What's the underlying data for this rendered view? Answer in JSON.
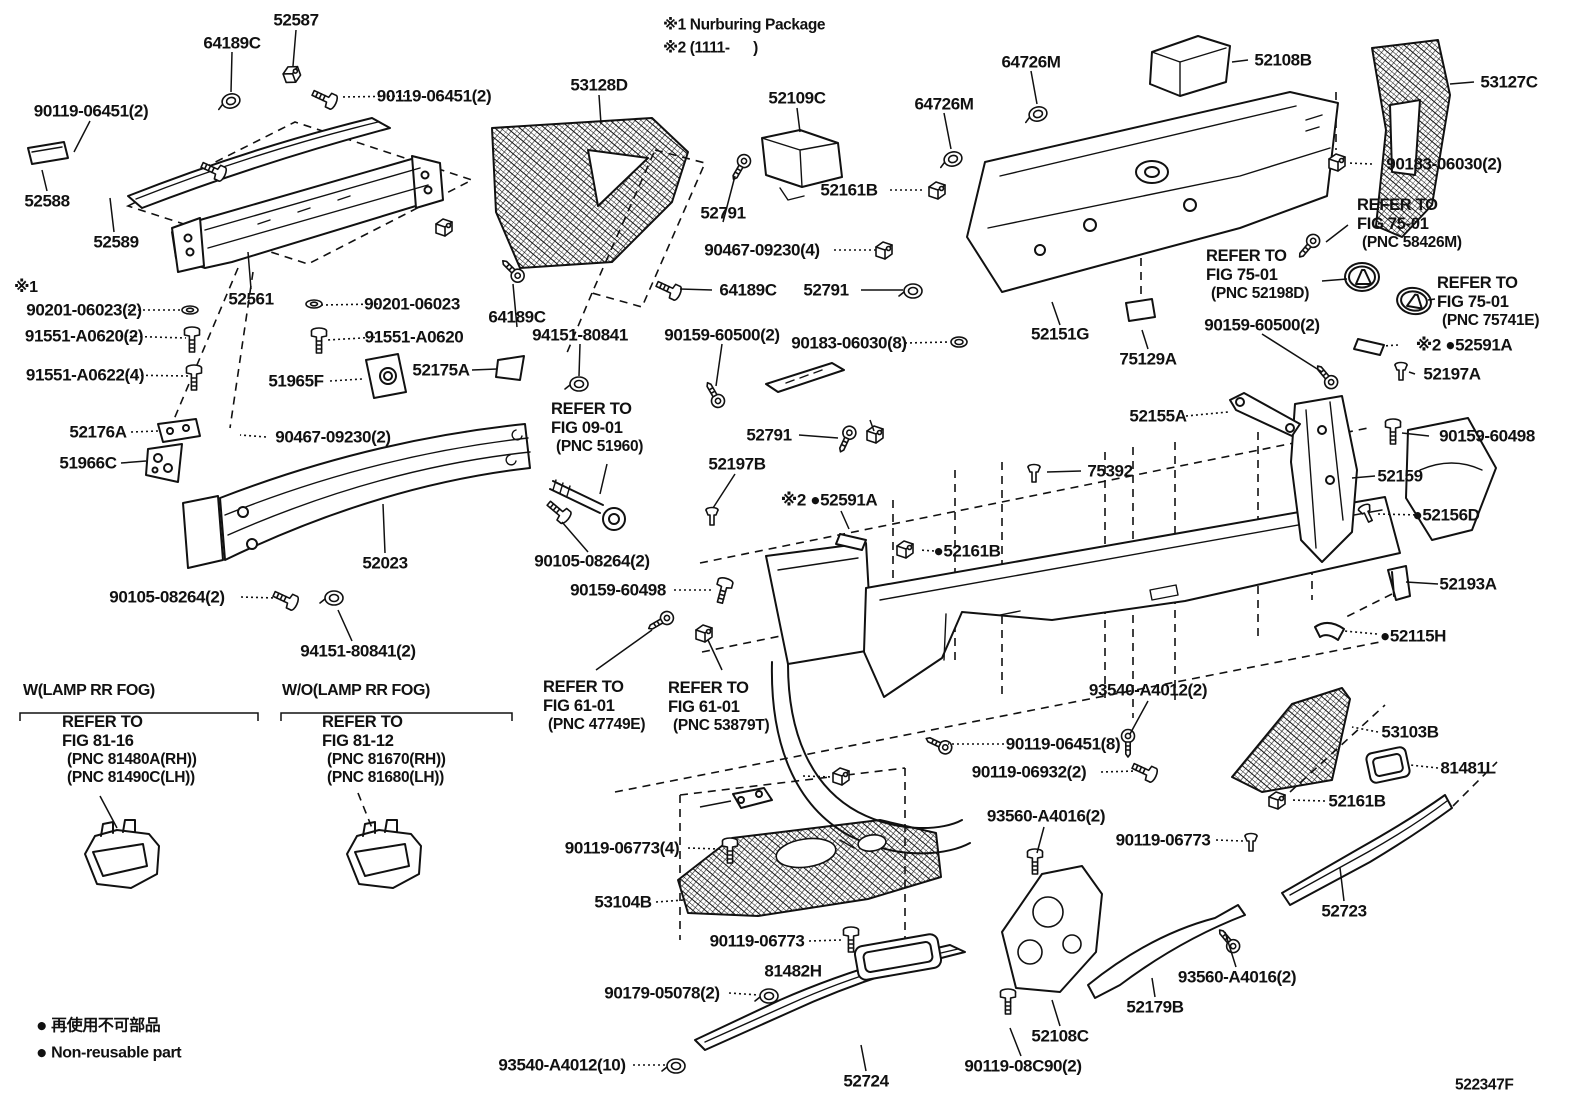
{
  "colors": {
    "ink": "#111111",
    "background": "#ffffff"
  },
  "code": {
    "t": "522347F",
    "x": 1455,
    "y": 1085
  },
  "notes": [
    {
      "t": "※1 Nurburing Package",
      "x": 663,
      "y": 25
    },
    {
      "t": "※2 (1111-      )",
      "x": 663,
      "y": 48
    }
  ],
  "legend": {
    "rows": [
      {
        "symbol": "●",
        "text": "再使用不可部品",
        "x": 36,
        "y": 1026
      },
      {
        "symbol": "●",
        "text": "Non-reusable part",
        "x": 36,
        "y": 1053
      }
    ]
  },
  "labels": [
    {
      "id": "52587",
      "t": "52587",
      "x": 296,
      "y": 20
    },
    {
      "id": "64189c-top",
      "t": "64189C",
      "x": 232,
      "y": 43
    },
    {
      "id": "90119-06451-2-left",
      "t": "90119-06451(2)",
      "x": 91,
      "y": 111
    },
    {
      "id": "90119-06451-2-right",
      "t": "90119-06451(2)",
      "x": 434,
      "y": 96
    },
    {
      "id": "52588",
      "t": "52588",
      "x": 47,
      "y": 201
    },
    {
      "id": "52589",
      "t": "52589",
      "x": 116,
      "y": 242
    },
    {
      "id": "53128d",
      "t": "53128D",
      "x": 599,
      "y": 85
    },
    {
      "id": "52109c",
      "t": "52109C",
      "x": 797,
      "y": 98
    },
    {
      "id": "64726m-upper",
      "t": "64726M",
      "x": 1031,
      "y": 62
    },
    {
      "id": "64726m-lower",
      "t": "64726M",
      "x": 944,
      "y": 104
    },
    {
      "id": "52108b",
      "t": "52108B",
      "x": 1283,
      "y": 60
    },
    {
      "id": "53127c",
      "t": "53127C",
      "x": 1509,
      "y": 82
    },
    {
      "id": "90183-06030-2",
      "t": "90183-06030(2)",
      "x": 1444,
      "y": 164
    },
    {
      "id": "52161b-top",
      "t": "52161B",
      "x": 849,
      "y": 190
    },
    {
      "id": "52791-top",
      "t": "52791",
      "x": 723,
      "y": 213
    },
    {
      "id": "90467-09230-4-top",
      "t": "90467-09230(4)",
      "x": 762,
      "y": 250
    },
    {
      "id": "64189c-mid2",
      "t": "64189C",
      "x": 748,
      "y": 290
    },
    {
      "id": "52791-mid",
      "t": "52791",
      "x": 826,
      "y": 290
    },
    {
      "id": "52151g",
      "t": "52151G",
      "x": 1060,
      "y": 334
    },
    {
      "id": "75129a",
      "t": "75129A",
      "x": 1148,
      "y": 359
    },
    {
      "id": "90159-60500-2-right",
      "t": "90159-60500(2)",
      "x": 1262,
      "y": 325
    },
    {
      "id": "52591a-right",
      "t": "※2 ●52591A",
      "x": 1464,
      "y": 345
    },
    {
      "id": "52197a",
      "t": "52197A",
      "x": 1452,
      "y": 374
    },
    {
      "id": "90159-60498-right",
      "t": "90159-60498",
      "x": 1487,
      "y": 436
    },
    {
      "id": "52159",
      "t": "52159",
      "x": 1400,
      "y": 476
    },
    {
      "id": "52156d",
      "t": "●52156D",
      "x": 1446,
      "y": 515
    },
    {
      "id": "52155a",
      "t": "52155A",
      "x": 1158,
      "y": 416
    },
    {
      "id": "90159-60500-2-left",
      "t": "90159-60500(2)",
      "x": 722,
      "y": 335
    },
    {
      "id": "90183-06030-8",
      "t": "90183-06030(8)",
      "x": 849,
      "y": 343
    },
    {
      "id": "64189c-mid",
      "t": "64189C",
      "x": 517,
      "y": 317
    },
    {
      "id": "94151-80841",
      "t": "94151-80841",
      "x": 580,
      "y": 335
    },
    {
      "id": "note1-mark",
      "t": "※1",
      "x": 14,
      "y": 288,
      "a": "l",
      "fs": 16
    },
    {
      "id": "90201-06023-2",
      "t": "90201-06023(2)",
      "x": 84,
      "y": 310
    },
    {
      "id": "91551-a0620-2",
      "t": "91551-A0620(2)",
      "x": 84,
      "y": 336
    },
    {
      "id": "91551-a0622-4",
      "t": "91551-A0622(4)",
      "x": 85,
      "y": 375
    },
    {
      "id": "52561",
      "t": "52561",
      "x": 251,
      "y": 299
    },
    {
      "id": "90201-06023",
      "t": "90201-06023",
      "x": 412,
      "y": 304
    },
    {
      "id": "91551-a0620",
      "t": "91551-A0620",
      "x": 414,
      "y": 337
    },
    {
      "id": "51965f",
      "t": "51965F",
      "x": 296,
      "y": 381
    },
    {
      "id": "52175a",
      "t": "52175A",
      "x": 441,
      "y": 370
    },
    {
      "id": "52176a",
      "t": "52176A",
      "x": 98,
      "y": 432
    },
    {
      "id": "90467-09230-2",
      "t": "90467-09230(2)",
      "x": 333,
      "y": 437
    },
    {
      "id": "51966c",
      "t": "51966C",
      "x": 88,
      "y": 463
    },
    {
      "id": "52023",
      "t": "52023",
      "x": 385,
      "y": 563
    },
    {
      "id": "90105-08264-2-left",
      "t": "90105-08264(2)",
      "x": 167,
      "y": 597
    },
    {
      "id": "94151-80841-2",
      "t": "94151-80841(2)",
      "x": 358,
      "y": 651
    },
    {
      "id": "90105-08264-2-mid",
      "t": "90105-08264(2)",
      "x": 592,
      "y": 561
    },
    {
      "id": "90159-60498-mid",
      "t": "90159-60498",
      "x": 618,
      "y": 590
    },
    {
      "id": "52791-center",
      "t": "52791",
      "x": 769,
      "y": 435
    },
    {
      "id": "52197b",
      "t": "52197B",
      "x": 737,
      "y": 464
    },
    {
      "id": "52591a-center",
      "t": "※2 ●52591A",
      "x": 829,
      "y": 500
    },
    {
      "id": "75392",
      "t": "75392",
      "x": 1110,
      "y": 471
    },
    {
      "id": "52161b-center",
      "t": "●52161B",
      "x": 967,
      "y": 551
    },
    {
      "id": "52193a",
      "t": "52193A",
      "x": 1468,
      "y": 584
    },
    {
      "id": "52115h",
      "t": "●52115H",
      "x": 1413,
      "y": 636
    },
    {
      "id": "93540-a4012-2",
      "t": "93540-A4012(2)",
      "x": 1148,
      "y": 690
    },
    {
      "id": "90119-06451-8",
      "t": "90119-06451(8)",
      "x": 1063,
      "y": 744
    },
    {
      "id": "90119-06932-2",
      "t": "90119-06932(2)",
      "x": 1029,
      "y": 772
    },
    {
      "id": "93560-a4016-2-left",
      "t": "93560-A4016(2)",
      "x": 1046,
      "y": 816
    },
    {
      "id": "53103b",
      "t": "53103B",
      "x": 1410,
      "y": 732
    },
    {
      "id": "81481l",
      "t": "81481L",
      "x": 1468,
      "y": 768
    },
    {
      "id": "52161b-bottom",
      "t": "52161B",
      "x": 1357,
      "y": 801
    },
    {
      "id": "90119-06773-right",
      "t": "90119-06773",
      "x": 1163,
      "y": 840
    },
    {
      "id": "90119-06773-4",
      "t": "90119-06773(4)",
      "x": 622,
      "y": 848
    },
    {
      "id": "53104b",
      "t": "53104B",
      "x": 623,
      "y": 902
    },
    {
      "id": "90119-06773-mid",
      "t": "90119-06773",
      "x": 757,
      "y": 941
    },
    {
      "id": "81482h",
      "t": "81482H",
      "x": 793,
      "y": 971
    },
    {
      "id": "90179-05078-2",
      "t": "90179-05078(2)",
      "x": 662,
      "y": 993
    },
    {
      "id": "93540-a4012-10",
      "t": "93540-A4012(10)",
      "x": 562,
      "y": 1065
    },
    {
      "id": "52724",
      "t": "52724",
      "x": 866,
      "y": 1081
    },
    {
      "id": "52723",
      "t": "52723",
      "x": 1344,
      "y": 911
    },
    {
      "id": "93560-a4016-2-right",
      "t": "93560-A4016(2)",
      "x": 1237,
      "y": 977
    },
    {
      "id": "52179b",
      "t": "52179B",
      "x": 1155,
      "y": 1007
    },
    {
      "id": "52108c",
      "t": "52108C",
      "x": 1060,
      "y": 1036
    },
    {
      "id": "90119-08c90-2",
      "t": "90119-08C90(2)",
      "x": 1023,
      "y": 1066
    },
    {
      "id": "w-lamp-header",
      "t": "W(LAMP RR FOG)",
      "x": 23,
      "y": 691,
      "a": "l",
      "fs": 16
    },
    {
      "id": "wo-lamp-header",
      "t": "W/O(LAMP RR FOG)",
      "x": 282,
      "y": 691,
      "a": "l",
      "fs": 16
    }
  ],
  "ref_blocks": [
    {
      "id": "fig-75-01-58426m",
      "lines": [
        "REFER TO",
        "FIG 75-01",
        "(PNC 58426M)"
      ],
      "x": 1357,
      "y": 196
    },
    {
      "id": "fig-75-01-52198d",
      "lines": [
        "REFER TO",
        "FIG 75-01",
        "(PNC 52198D)"
      ],
      "x": 1206,
      "y": 247
    },
    {
      "id": "fig-75-01-75741e",
      "lines": [
        "REFER TO",
        "FIG 75-01",
        "(PNC 75741E)"
      ],
      "x": 1437,
      "y": 274
    },
    {
      "id": "fig-09-01-51960",
      "lines": [
        "REFER TO",
        "FIG 09-01",
        "(PNC 51960)"
      ],
      "x": 551,
      "y": 400
    },
    {
      "id": "fig-61-01-47749e",
      "lines": [
        "REFER TO",
        "FIG 61-01",
        "(PNC 47749E)"
      ],
      "x": 543,
      "y": 678
    },
    {
      "id": "fig-61-01-53879t",
      "lines": [
        "REFER TO",
        "FIG 61-01",
        "(PNC 53879T)"
      ],
      "x": 668,
      "y": 679
    },
    {
      "id": "fig-81-16",
      "lines": [
        "REFER TO",
        "FIG 81-16",
        "(PNC 81480A(RH))",
        "(PNC 81490C(LH))"
      ],
      "x": 62,
      "y": 713
    },
    {
      "id": "fig-81-12",
      "lines": [
        "REFER TO",
        "FIG 81-12",
        "(PNC 81670(RH))",
        "(PNC 81680(LH))"
      ],
      "x": 322,
      "y": 713
    }
  ]
}
